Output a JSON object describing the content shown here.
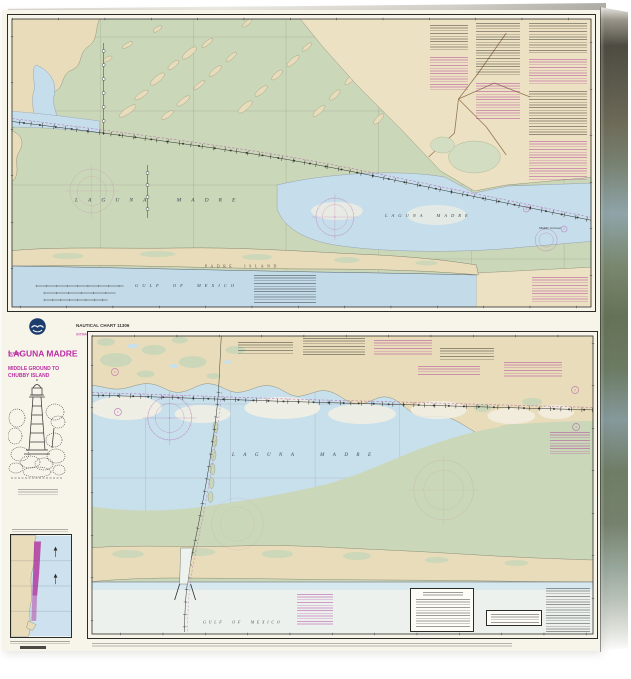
{
  "title_block": {
    "chart_label": "NAUTICAL CHART 11306",
    "chart_sublabel": "INTRACOASTAL WATERWAY",
    "state": "TEXAS",
    "title": "LAGUNA MADRE",
    "subtitle_line1": "MIDDLE GROUND TO",
    "subtitle_line2": "CHUBBY ISLAND"
  },
  "top_chart": {
    "labels": {
      "laguna_west": "LAGUNA MADRE",
      "laguna_east": "LAGUNA MADRE",
      "padre_island": "PADRE ISLAND",
      "gulf": "GULF OF MEXICO",
      "middle_ground": "Middle Ground"
    }
  },
  "bottom_chart": {
    "labels": {
      "laguna": "LAGUNA MADRE",
      "gulf": "GULF OF MEXICO"
    }
  },
  "colors": {
    "land": "#e8dcba",
    "shallow_green": "#cbd7b9",
    "water_blue": "#c6ddeb",
    "magenta": "#bb2fa4",
    "paper": "#f7f4ea"
  }
}
